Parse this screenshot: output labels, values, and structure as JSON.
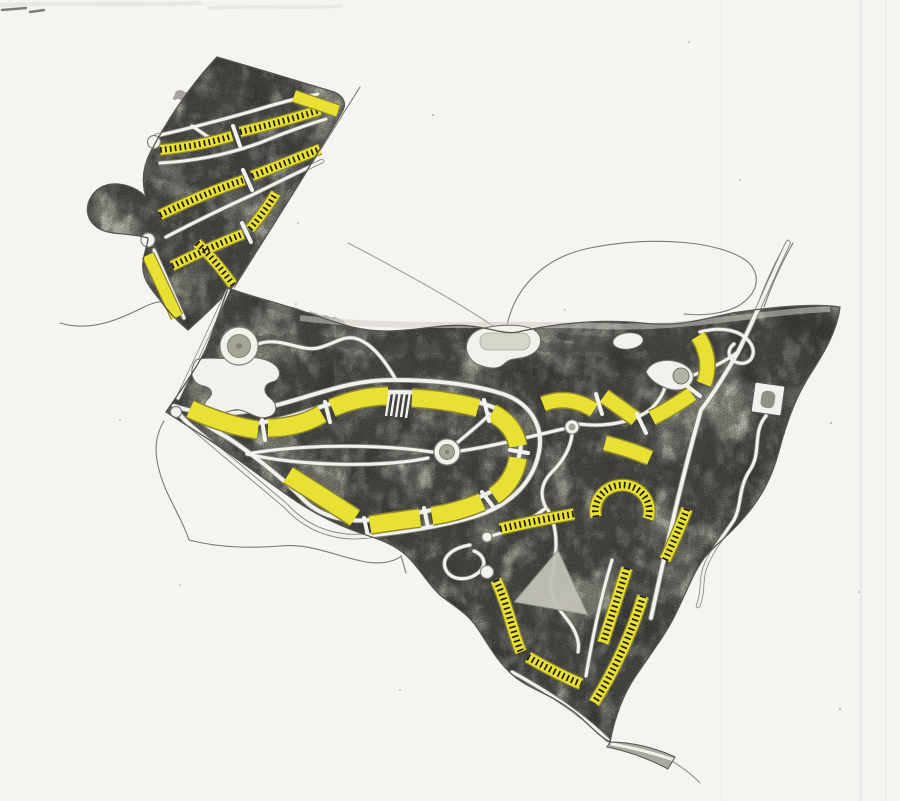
{
  "document": {
    "kind": "hand-drawn masterplan site sketch",
    "medium": "graphite pencil terrain with yellow marker building blocks on white paper",
    "visible_text": "none"
  },
  "palette": {
    "paper": "#f5f4f0",
    "paper_shadow": "#e9e7e2",
    "crease": "#dcdfe8",
    "terrain_base": "#a9a89d",
    "terrain_tint": "#c5c6ad",
    "terrain_dark": "#3c3b37",
    "road_fill": "#f2f1ec",
    "road_edge": "#85847a",
    "outline": "#56554f",
    "building_yellow": "#e8e032",
    "building_yellow_edge": "#8e8730",
    "tick_black": "#1c1b17",
    "sketch_line": "#7a7974",
    "clearing": "#d7d6cb"
  },
  "features": {
    "north_parcel": {
      "shape": "triangular hillside parcel, upper left",
      "ticked_housing_rows": 7,
      "plain_yellow_blocks": 2,
      "cul_de_sacs": 2
    },
    "main_parcel": {
      "shape": "large wedge parcel, centre and lower right",
      "loop_road_blocks": 9,
      "east_curve_blocks": 5,
      "ticked_housing_rows": 7,
      "roundabouts": 2,
      "cul_de_sacs": 4,
      "circular_plaza": 1,
      "building_plot_square": 1,
      "clearings": 3,
      "hill_triangle": 1
    },
    "offsite": {
      "sketch_road_lines": 6,
      "paper_creases": 3
    }
  }
}
